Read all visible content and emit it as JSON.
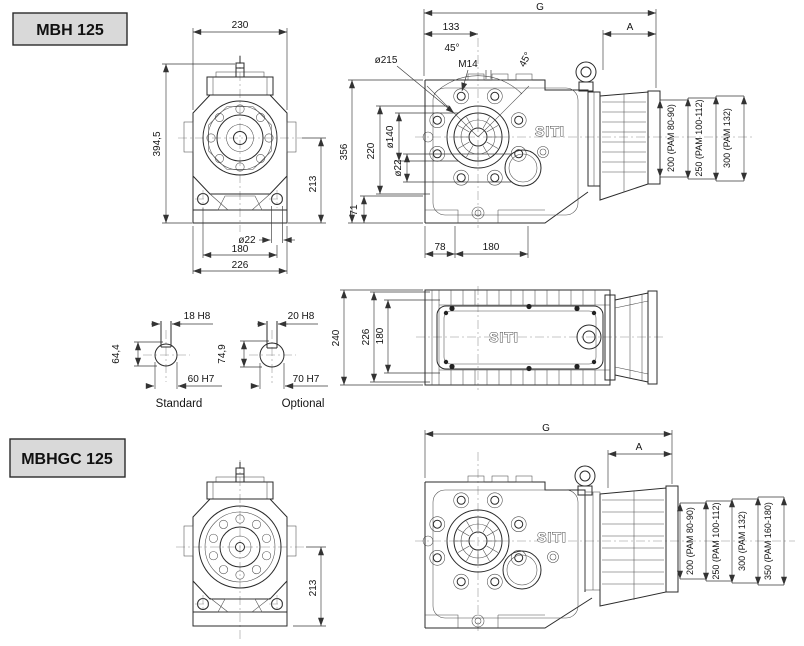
{
  "brand": "SITI",
  "mbh": {
    "title": "MBH 125",
    "front": {
      "top_width": "230",
      "overall_height": "394,5",
      "axis_height": "213",
      "foot_hole": "ø22",
      "foot_span": "180",
      "base_width": "226"
    },
    "side": {
      "overall": "G",
      "flange_to_axis": "133",
      "motor": "A",
      "angle_left": "45°",
      "tap": "M14",
      "angle_right": "45°",
      "flange_dia": "ø215",
      "spigot_dia": "ø140",
      "height": "356",
      "axis": "220",
      "bore": "ø22",
      "foot_height": "71",
      "foot_a": "78",
      "foot_b": "180",
      "pam": [
        "200 (PAM 80-90)",
        "250 (PAM 100-112)",
        "300 (PAM 132)"
      ]
    },
    "top": {
      "overall": "240",
      "body": "226",
      "cover": "180"
    }
  },
  "shafts": {
    "standard": {
      "label": "Standard",
      "keyway": "18 H8",
      "depth": "64,4",
      "bore": "60 H7"
    },
    "optional": {
      "label": "Optional",
      "keyway": "20 H8",
      "depth": "74,9",
      "bore": "70 H7"
    }
  },
  "mbhgc": {
    "title": "MBHGC 125",
    "front": {
      "axis_height": "213"
    },
    "side": {
      "overall": "G",
      "motor": "A",
      "pam": [
        "200 (PAM 80-90)",
        "250 (PAM 100-112)",
        "300 (PAM 132)",
        "350 (PAM 160-180)"
      ]
    }
  }
}
